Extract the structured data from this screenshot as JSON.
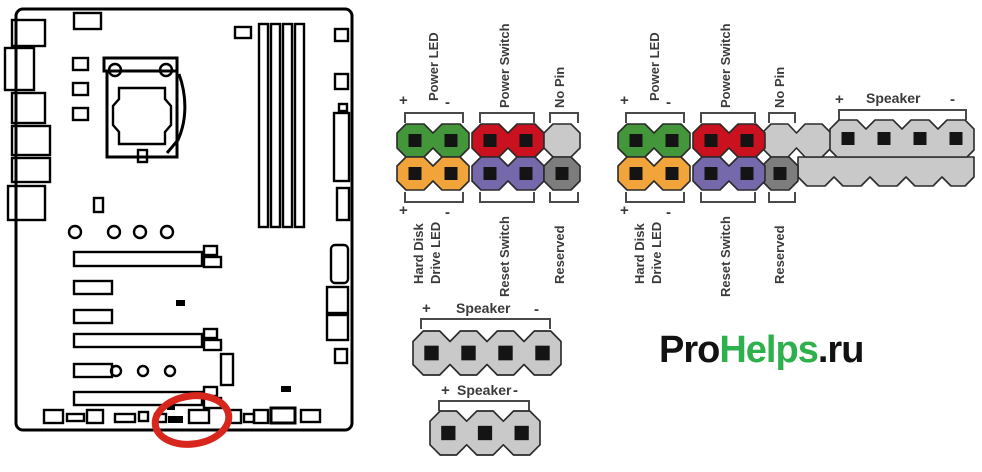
{
  "colors": {
    "pin_green": "#43973a",
    "pin_red": "#c9111f",
    "pin_orange": "#f1a43a",
    "pin_purple": "#7568ab",
    "pin_gray": "#c9c9c9",
    "pin_gray_dark": "#7d7d7d",
    "pin_hole": "#141414",
    "pin_outline": "#2a2a2a",
    "label": "#3b3b3b",
    "bracket": "#4a4a4a",
    "highlight": "#d7271d",
    "brand_green": "#2eb04c",
    "brand_dark": "#121212",
    "board": "#000000"
  },
  "front_panel_left": {
    "power_led": {
      "plus": "+",
      "label": "Power LED",
      "minus": "-"
    },
    "power_switch": {
      "label": "Power Switch"
    },
    "no_pin": {
      "label": "No Pin"
    },
    "hdd_led": {
      "plus": "+",
      "line1": "Hard Disk",
      "line2": "Drive LED",
      "minus": "-"
    },
    "reset_switch": {
      "label": "Reset Switch"
    },
    "reserved": {
      "label": "Reserved"
    }
  },
  "front_panel_right": {
    "power_led": {
      "plus": "+",
      "label": "Power LED",
      "minus": "-"
    },
    "power_switch": {
      "label": "Power Switch"
    },
    "no_pin": {
      "label": "No Pin"
    },
    "speaker": {
      "plus": "+",
      "label": "Speaker",
      "minus": "-"
    },
    "hdd_led": {
      "plus": "+",
      "line1": "Hard Disk",
      "line2": "Drive LED",
      "minus": "-"
    },
    "reset_switch": {
      "label": "Reset Switch"
    },
    "reserved": {
      "label": "Reserved"
    }
  },
  "speaker_connector_4pin": {
    "plus": "+",
    "label": "Speaker",
    "minus": "-"
  },
  "speaker_connector_3pin": {
    "plus": "+",
    "label": "Speaker",
    "minus": "-"
  },
  "watermark": {
    "pro": "Pro",
    "helps": "Helps",
    "domain": ".ru"
  }
}
